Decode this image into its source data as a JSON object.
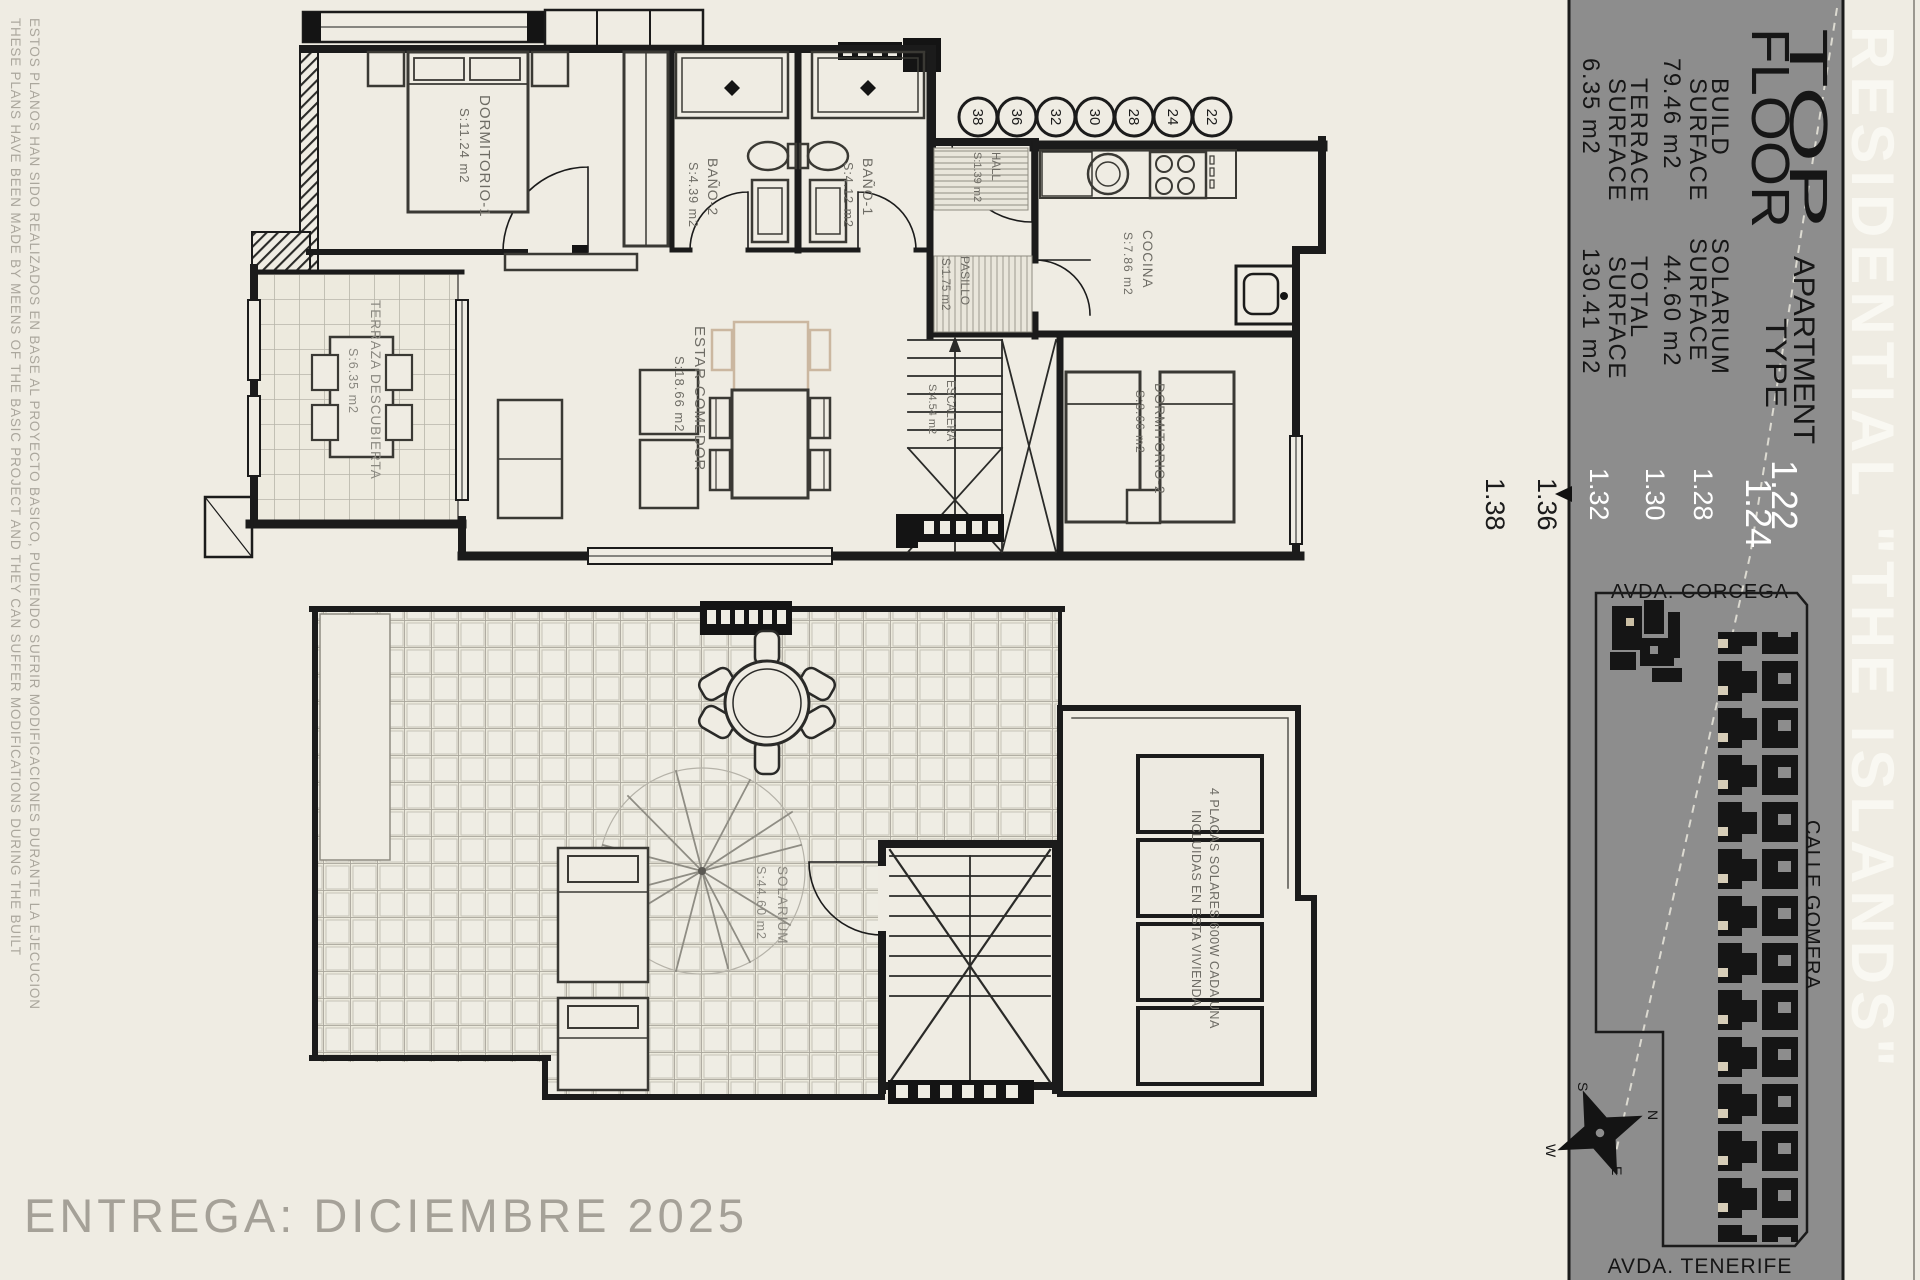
{
  "brand": "RESIDENTIAL \"THE ISLANDS\"",
  "delivery": "ENTREGA: DICIEMBRE 2025",
  "disclaimer": {
    "en": "THESE PLANS HAVE BEEN MADE BY MEENS OF THE BASIC PROJECT AND THEY CAN SUFFER MODIFICATIONS DURING THE BUILT",
    "es": "ESTOS PLANOS HAN SIDO REALIZADOS EN BASE AL PROYECTO BASICO, PUDIENDO SUFRIR MODIFICACIONES DURANTE LA EJECUCION"
  },
  "title_block": {
    "floor_word1": "TOP",
    "floor_word2": "FLOOR",
    "apt_word1": "APARTMENT",
    "apt_word2": "TYPE",
    "apt_type1": "1.22",
    "apt_type2": "1.24",
    "build_l1": "BUILD",
    "build_l2": "SURFACE",
    "build_v": "79.46 m2",
    "solarium_l1": "SOLARIUM",
    "solarium_l2": "SURFACE",
    "solarium_v": "44.60 m2",
    "terrace_l1": "TERRACE",
    "terrace_l2": "SURFACE",
    "terrace_v": "6.35 m2",
    "total_l1": "TOTAL",
    "total_l2": "SURFACE",
    "total_v": "130.41 m2"
  },
  "unit_numbers": {
    "white": [
      "1.28",
      "1.30",
      "1.32"
    ],
    "black": [
      "1.36",
      "1.38"
    ]
  },
  "plot_circles": [
    "38",
    "36",
    "32",
    "30",
    "28",
    "24",
    "22"
  ],
  "site_plan": {
    "street_top": "AVDA. CORCEGA",
    "street_right": "CALLE GOMERA",
    "street_bottom": "AVDA. TENERIFE",
    "compass": {
      "n": "N",
      "s": "S",
      "e": "E",
      "w": "W"
    }
  },
  "upper_rooms": {
    "dorm1": {
      "name": "DORMITORIO-1",
      "area": "S:11.24 m2"
    },
    "bath2": {
      "name": "BAÑO-2",
      "area": "S:4.39 m2"
    },
    "bath1": {
      "name": "BAÑO-1",
      "area": "S:4.12 m2"
    },
    "hall": {
      "name": "HALL",
      "area": "S:1.39 m2"
    },
    "kitchen": {
      "name": "COCINA",
      "area": "S:7.86 m2"
    },
    "pasillo": {
      "name": "PASILLO",
      "area": "S:1.75 m2"
    },
    "stairs": {
      "name": "ESCALERA",
      "area": "S:4.54 m2"
    },
    "living": {
      "name": "ESTAR-COMEDOR",
      "area": "S:18.66 m2"
    },
    "dorm2": {
      "name": "DORMITORIO-2",
      "area": "S:8.66 m2"
    },
    "terrace": {
      "name": "TERRAZA DESCUBIERTA",
      "area": "S:6.35 m2"
    }
  },
  "lower_rooms": {
    "solarium": {
      "name": "SOLARIUM",
      "area": "S:44.60 m2"
    },
    "solar_note1": "4 PLACAS SOLARES 600W CADA UNA",
    "solar_note2": "INCLUIDAS EN ESTA VIVIENDA"
  },
  "colors": {
    "paper": "#efece3",
    "band_gray": "#8d8d8d",
    "ink": "#1b1b1b",
    "label_gray": "#6e6c65",
    "tan_accent": "#cdb79e",
    "white": "#ffffff"
  }
}
